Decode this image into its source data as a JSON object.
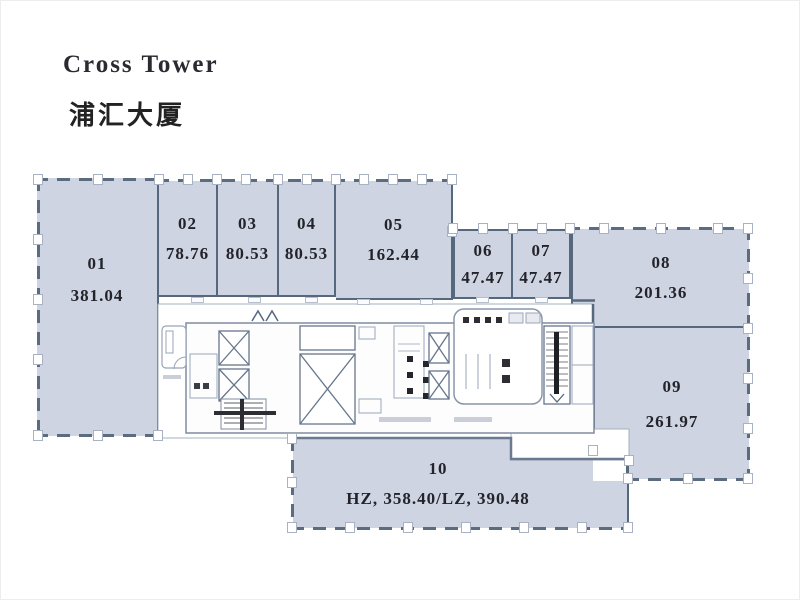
{
  "title": {
    "en": "Cross Tower",
    "zh": "浦汇大厦"
  },
  "floorplan": {
    "units": [
      {
        "id": "01",
        "area": "381.04"
      },
      {
        "id": "02",
        "area": "78.76"
      },
      {
        "id": "03",
        "area": "80.53"
      },
      {
        "id": "04",
        "area": "80.53"
      },
      {
        "id": "05",
        "area": "162.44"
      },
      {
        "id": "06",
        "area": "47.47"
      },
      {
        "id": "07",
        "area": "47.47"
      },
      {
        "id": "08",
        "area": "201.36"
      },
      {
        "id": "09",
        "area": "261.97"
      },
      {
        "id": "10",
        "area": "HZ, 358.40/LZ, 390.48"
      }
    ],
    "core_features": [
      "elevator-shafts",
      "stairwells",
      "washrooms",
      "lobby"
    ]
  },
  "colors": {
    "unit_fill": "#cfd4e2",
    "wall_dark": "#56687e",
    "wall_light": "#a6b0bf",
    "text": "#23242b",
    "background": "#ffffff"
  }
}
